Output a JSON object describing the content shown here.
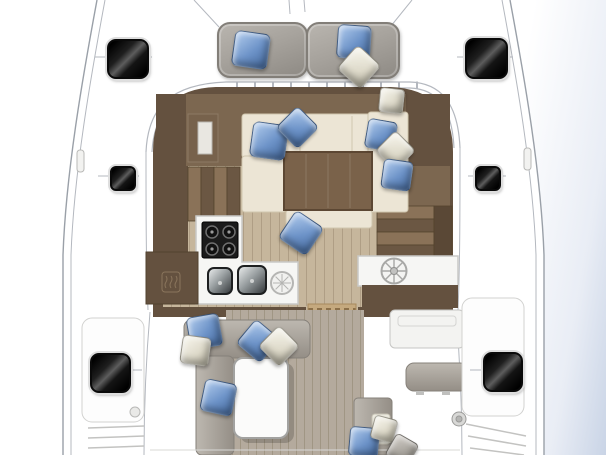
{
  "scene": {
    "type": "catamaran-deck-floor-plan",
    "areas": [
      "bow-sunpads",
      "saloon",
      "galley",
      "nav-counter",
      "cockpit",
      "side-decks",
      "transom-steps"
    ]
  },
  "colors": {
    "water": "#c9d4e6",
    "line": "#b4b8bf",
    "line-strong": "#9aa0a8",
    "deck": "#ffffff",
    "hatch-frame": "#dedede",
    "sunpad": "#a7a39d",
    "sunpad-dark": "#827e78",
    "pillow-blue-1": "#a9c5e9",
    "pillow-blue-2": "#486da1",
    "pillow-cream-1": "#f4f2e8",
    "pillow-cream-2": "#b5b1a0",
    "wood-dark": "#64513f",
    "wood-mid": "#7c6750",
    "wood-light": "#8a7258",
    "floor-tan": "#c6b69c",
    "seat-cream": "#ece5d5",
    "seat-cream-edge": "#d0c6ae",
    "table-wood": "#7a624a",
    "galley-white": "#f6f6f4",
    "steel-dark": "#1b1b1b",
    "teak": "#b4aa9d",
    "teak-line": "#a09684",
    "sofa-gray": "#a19b93",
    "sofa-gray-dark": "#86817a",
    "mat-tan": "#c5a97e",
    "mat-dot": "#8c7049",
    "white-table": "#fbfbfa"
  },
  "sunpads": [
    {
      "name": "sunpad-port",
      "x": 217,
      "y": 22,
      "w": 87,
      "h": 52
    },
    {
      "name": "sunpad-starboard",
      "x": 306,
      "y": 22,
      "w": 90,
      "h": 53
    }
  ],
  "hatches": [
    {
      "name": "deck-hatch-port-forward",
      "x": 107,
      "y": 39,
      "w": 38,
      "h": 36,
      "r": 9
    },
    {
      "name": "deck-hatch-starboard-forward",
      "x": 465,
      "y": 38,
      "w": 39,
      "h": 37,
      "r": 9
    },
    {
      "name": "deck-hatch-port-small",
      "x": 110,
      "y": 166,
      "w": 22,
      "h": 21,
      "r": 6
    },
    {
      "name": "deck-hatch-starboard-small",
      "x": 475,
      "y": 166,
      "w": 22,
      "h": 21,
      "r": 6
    },
    {
      "name": "deck-hatch-port-aft",
      "x": 90,
      "y": 353,
      "w": 37,
      "h": 36,
      "r": 9
    },
    {
      "name": "deck-hatch-starboard-aft",
      "x": 483,
      "y": 352,
      "w": 36,
      "h": 36,
      "r": 9
    }
  ],
  "pillows": [
    {
      "name": "pillow-sunpad-port-blue",
      "cx": 250,
      "cy": 49,
      "size": 34,
      "rot": 8,
      "color": "blue"
    },
    {
      "name": "pillow-sunpad-stbd-blue",
      "cx": 353,
      "cy": 41,
      "size": 32,
      "rot": 4,
      "color": "blue"
    },
    {
      "name": "pillow-sunpad-stbd-cream",
      "cx": 358,
      "cy": 66,
      "size": 30,
      "rot": 42,
      "color": "cream"
    },
    {
      "name": "pillow-saloon-fwd-blue-1",
      "cx": 268,
      "cy": 140,
      "size": 34,
      "rot": 8,
      "color": "blue"
    },
    {
      "name": "pillow-saloon-fwd-blue-2",
      "cx": 296,
      "cy": 126,
      "size": 29,
      "rot": 45,
      "color": "blue"
    },
    {
      "name": "pillow-saloon-entry-cream",
      "cx": 390,
      "cy": 99,
      "size": 23,
      "rot": 6,
      "color": "cream"
    },
    {
      "name": "pillow-saloon-right-blue-1",
      "cx": 380,
      "cy": 134,
      "size": 28,
      "rot": 10,
      "color": "blue"
    },
    {
      "name": "pillow-saloon-right-cream",
      "cx": 394,
      "cy": 149,
      "size": 27,
      "rot": 45,
      "color": "cream"
    },
    {
      "name": "pillow-saloon-right-blue-2",
      "cx": 396,
      "cy": 174,
      "size": 28,
      "rot": 8,
      "color": "blue"
    },
    {
      "name": "pillow-galley-blue",
      "cx": 300,
      "cy": 232,
      "size": 32,
      "rot": 34,
      "color": "blue"
    },
    {
      "name": "pillow-cockpit-blue-1",
      "cx": 203,
      "cy": 330,
      "size": 31,
      "rot": -10,
      "color": "blue"
    },
    {
      "name": "pillow-cockpit-cream-1",
      "cx": 194,
      "cy": 349,
      "size": 27,
      "rot": 8,
      "color": "cream"
    },
    {
      "name": "pillow-cockpit-blue-2",
      "cx": 257,
      "cy": 340,
      "size": 30,
      "rot": 40,
      "color": "blue"
    },
    {
      "name": "pillow-cockpit-cream-2",
      "cx": 278,
      "cy": 345,
      "size": 28,
      "rot": 45,
      "color": "cream"
    },
    {
      "name": "pillow-cockpit-blue-3",
      "cx": 217,
      "cy": 396,
      "size": 31,
      "rot": 12,
      "color": "blue"
    },
    {
      "name": "pillow-aft-blue",
      "cx": 363,
      "cy": 441,
      "size": 28,
      "rot": 5,
      "color": "blue"
    },
    {
      "name": "pillow-aft-cream",
      "cx": 383,
      "cy": 428,
      "size": 22,
      "rot": 15,
      "color": "cream"
    },
    {
      "name": "pillow-aft-gray",
      "cx": 401,
      "cy": 449,
      "size": 24,
      "rot": 30,
      "color": "gray"
    }
  ]
}
